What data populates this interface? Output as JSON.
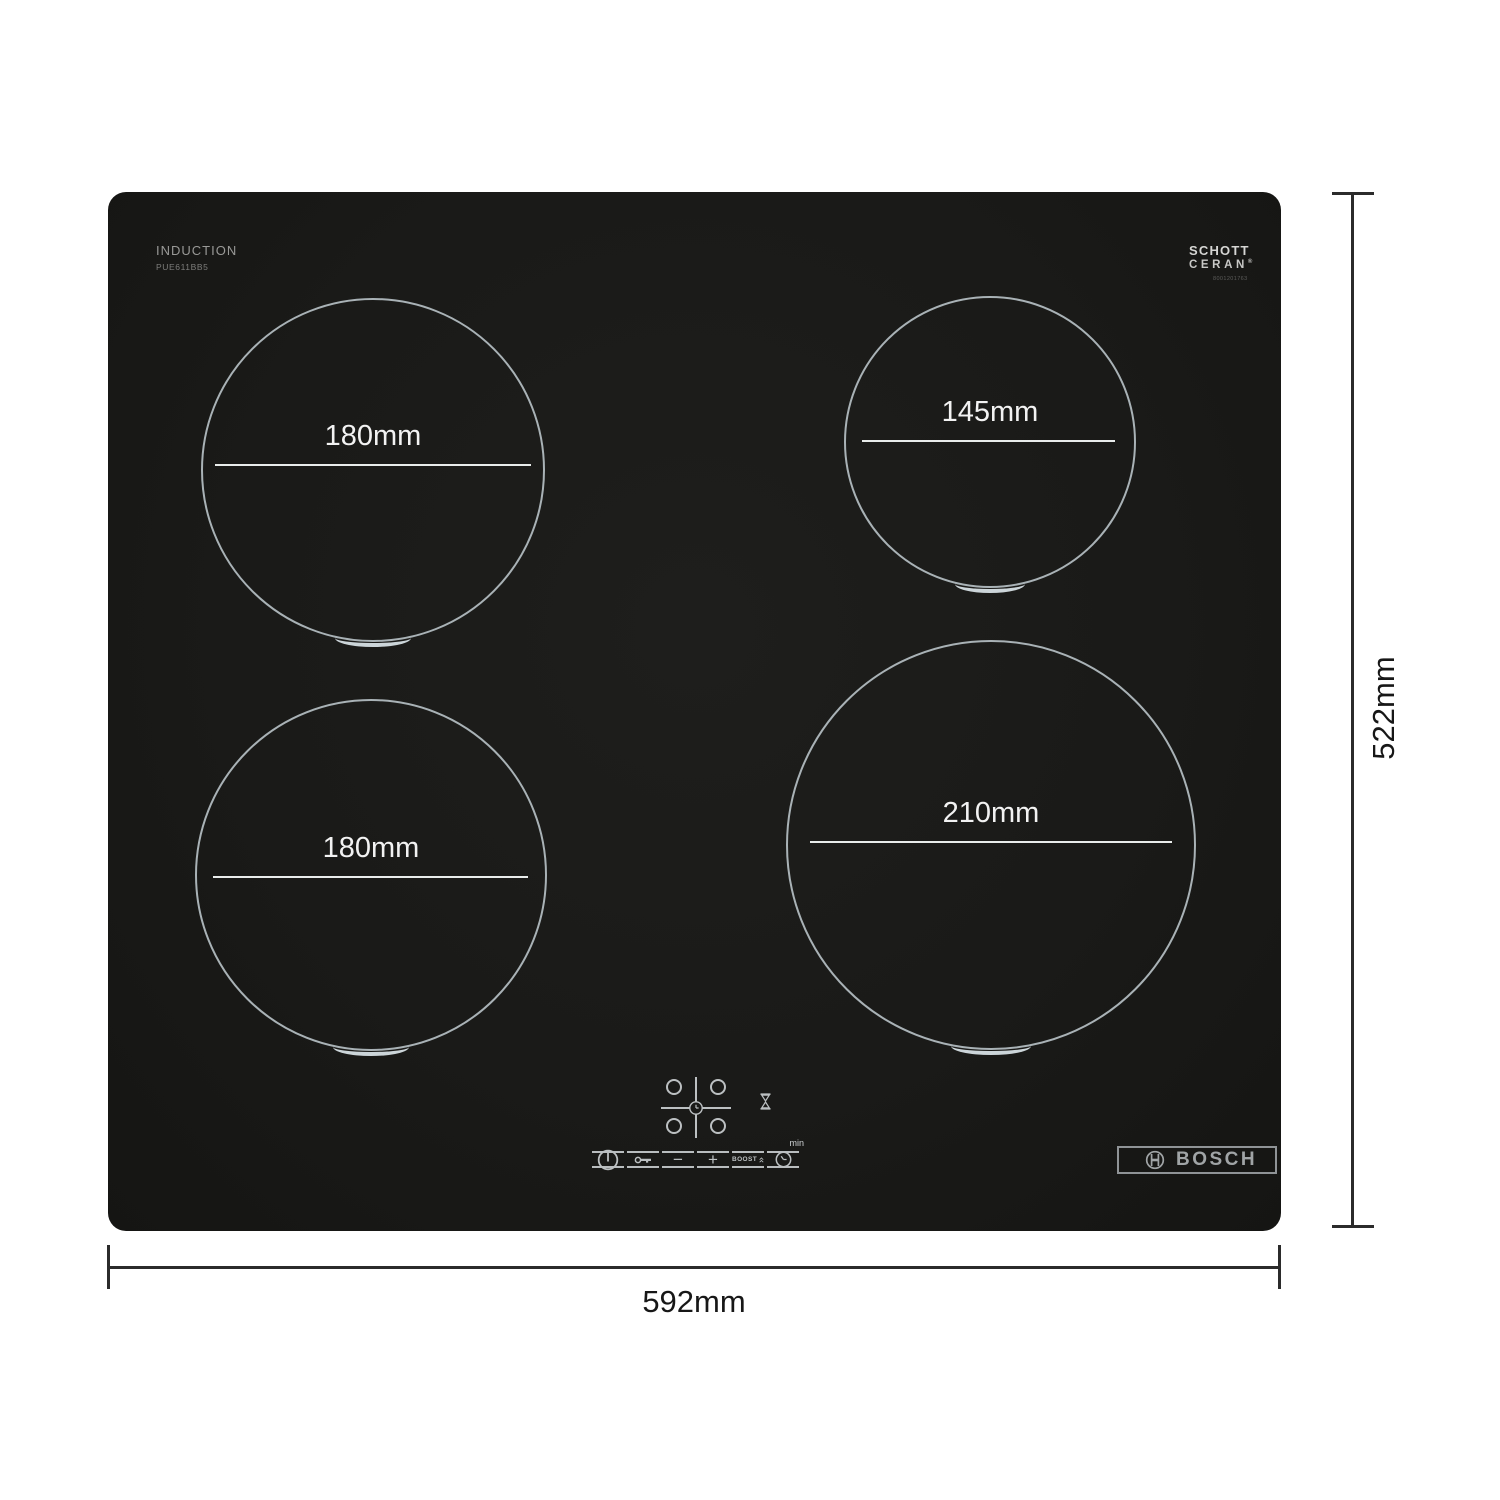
{
  "hob": {
    "type_label": "INDUCTION",
    "model_number": "PUE611BB5",
    "schott_ceran": {
      "line1": "SCHOTT",
      "line2": "CERAN",
      "registered_mark": "®",
      "code": "8001201763"
    },
    "bosch_wordmark": "BOSCH"
  },
  "zones": [
    {
      "position": "rear-left",
      "diameter_label": "180mm"
    },
    {
      "position": "rear-right",
      "diameter_label": "145mm"
    },
    {
      "position": "front-left",
      "diameter_label": "180mm"
    },
    {
      "position": "front-right",
      "diameter_label": "210mm"
    }
  ],
  "controls": {
    "minus_glyph": "−",
    "plus_glyph": "+",
    "boost_label": "BOOST",
    "min_unit_label": "min",
    "icons": [
      "power-icon",
      "key-lock-icon",
      "minus-icon",
      "plus-icon",
      "boost-chevrons-icon",
      "timer-clock-icon",
      "zone-selector-clock-icon",
      "hourglass-icon",
      "bosch-emblem-icon"
    ]
  },
  "dimensions": {
    "width_label": "592mm",
    "height_label": "522mm"
  },
  "colors": {
    "surface": "#1a1a18",
    "zone_ring": "#a9b2b6",
    "zone_marker": "#ccd5d9",
    "zone_label_text": "#f2f2f2",
    "control_icon": "#bcc0c2",
    "bosch_logo": "#a0a4a6",
    "dimension_line": "#2b2b2b",
    "dimension_text": "#171717",
    "page_background": "#ffffff"
  }
}
